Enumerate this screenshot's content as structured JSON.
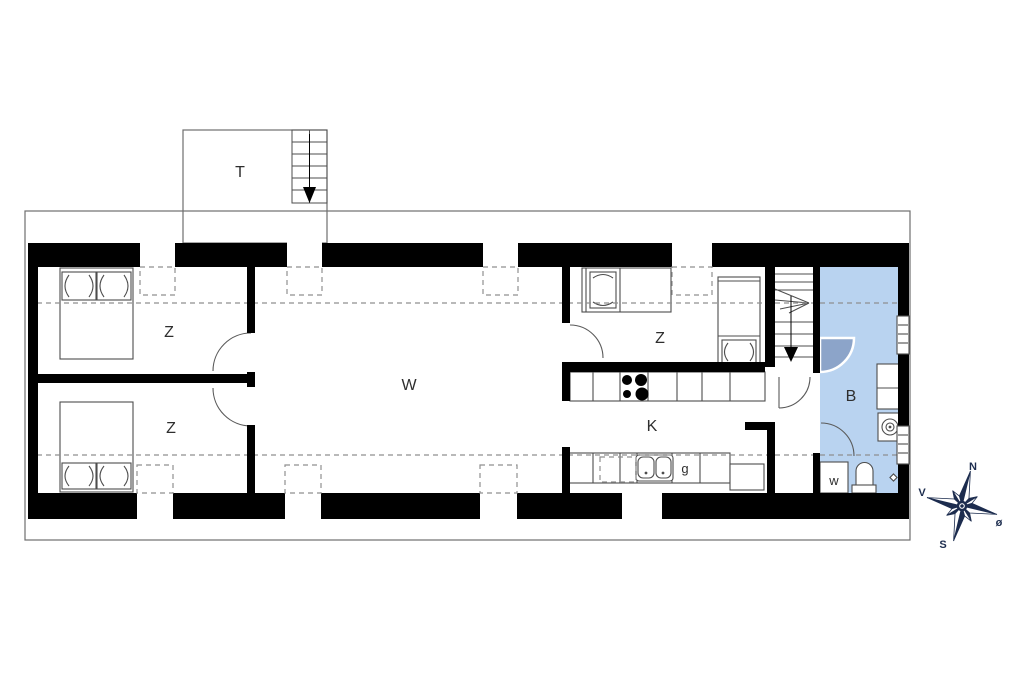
{
  "plan": {
    "rooms": {
      "terrace": "T",
      "bedroom_top_left": "Z",
      "bedroom_bottom_left": "Z",
      "living_room": "W",
      "bedroom_right": "Z",
      "kitchen": "K",
      "bathroom": "B"
    },
    "appliances": {
      "dishwasher": "g",
      "washing_machine": "w"
    }
  },
  "compass": {
    "north": "N",
    "west": "V",
    "south": "S",
    "east": "ø"
  },
  "colors": {
    "wall": "#000000",
    "bathroom_fill": "#b9d3f0",
    "shower_fill": "#8ca4c9",
    "furniture_line": "#4d4d4d",
    "dashed_line": "#8f8f8f",
    "outline": "#6e6e6e",
    "label_text": "#2e2e2e",
    "compass_color": "#1c2c4e"
  }
}
